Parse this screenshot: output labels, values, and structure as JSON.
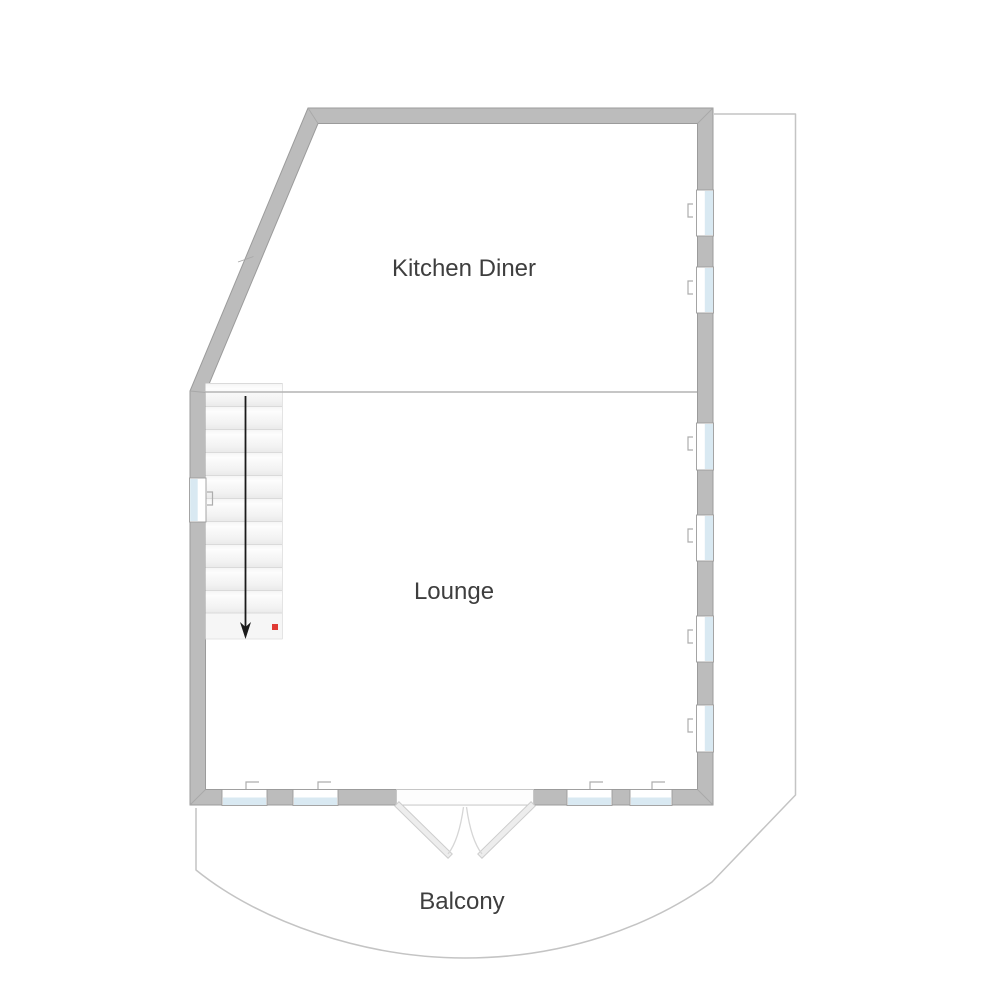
{
  "floorplan": {
    "rooms": [
      {
        "label": "Kitchen Diner"
      },
      {
        "label": "Lounge"
      }
    ],
    "outdoor_area": {
      "label": "Balcony"
    },
    "stairs": {
      "steps": 10,
      "direction_icon": "stairs-down-arrow",
      "marker_color": "#e03a34"
    },
    "features": {
      "right_wall_windows": 6,
      "bottom_wall_windows": 4,
      "left_wall_windows": 1,
      "double_doors": 1
    },
    "colors": {
      "wall": "#bcbcbc",
      "wall_outline": "#9b9b9b",
      "window_glass": "#d9e9f2",
      "divider_line": "#b4b4b4",
      "balcony_outline": "#c4c4c4",
      "label_text": "#3e3e3e",
      "background": "#ffffff"
    }
  }
}
